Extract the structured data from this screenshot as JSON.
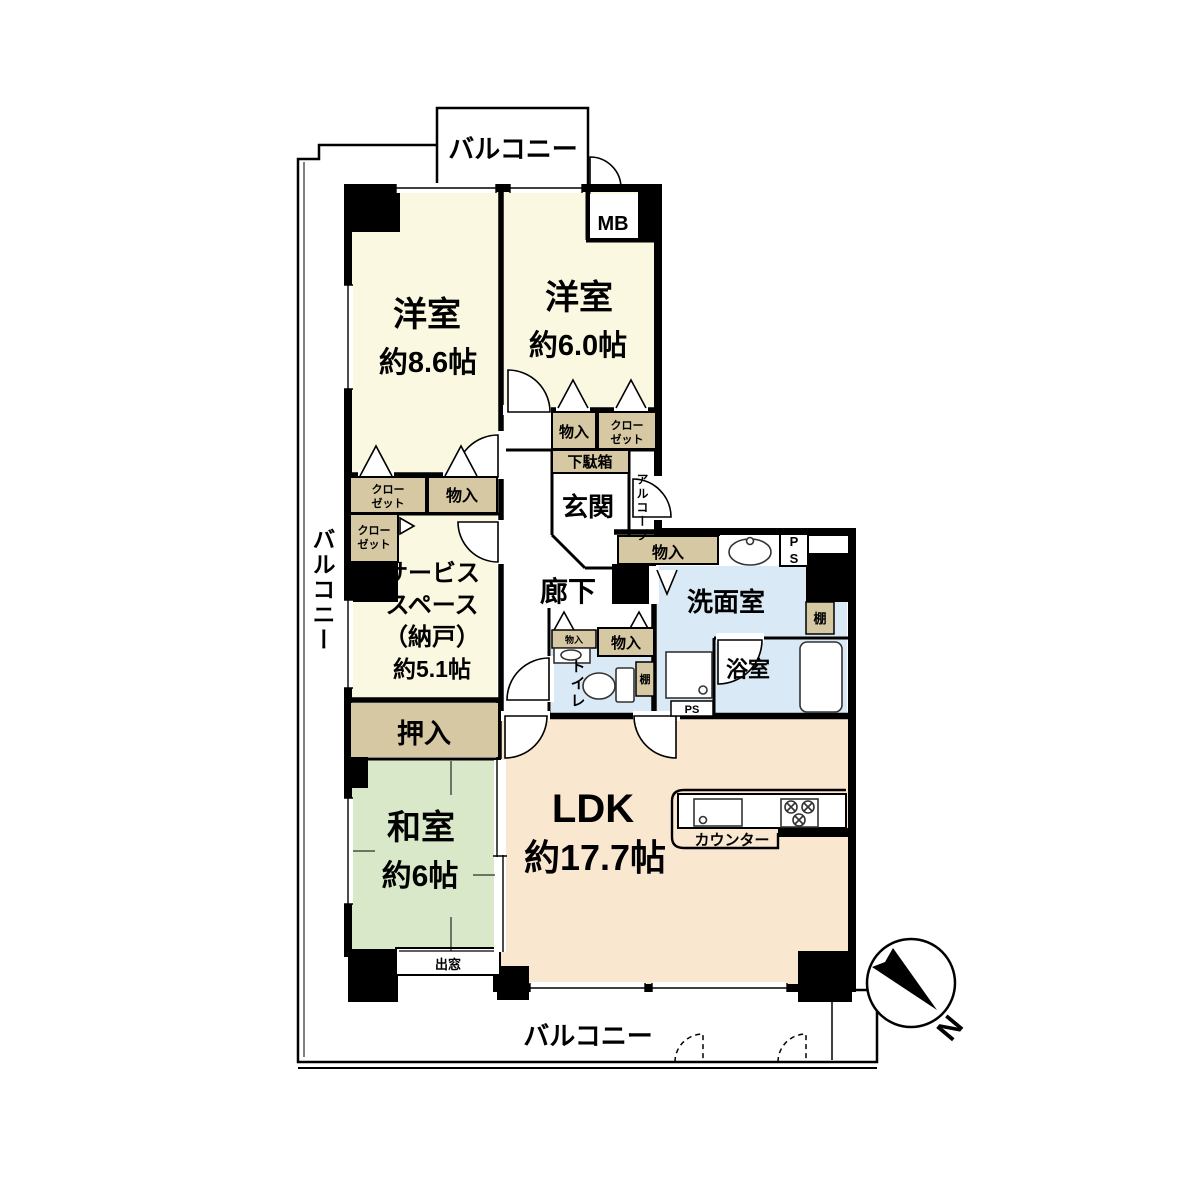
{
  "fp": {
    "balconies": {
      "top": "バルコニー",
      "left": "バルコニー",
      "bottom": "バルコニー"
    },
    "rooms": {
      "western1": {
        "name": "洋室",
        "size": "約8.6帖"
      },
      "western2": {
        "name": "洋室",
        "size": "約6.0帖"
      },
      "service": {
        "l1": "サービス",
        "l2": "スペース",
        "l3": "（納戸）",
        "l4": "約5.1帖"
      },
      "japanese": {
        "name": "和室",
        "size": "約6帖"
      },
      "ldk": {
        "name": "LDK",
        "size": "約17.7帖"
      },
      "genkan": "玄関",
      "hallway": "廊下",
      "washroom": "洗面室",
      "bathroom": "浴室",
      "toilet": "トイレ",
      "alcove": "アルコープ"
    },
    "storage": {
      "mb": "MB",
      "monoire": "物入",
      "closet1": "クロー",
      "closet2": "ゼット",
      "getabako": "下駄箱",
      "oshiire": "押入",
      "shelf": "棚",
      "ps": "PS",
      "baywindow": "出窓",
      "counter": "カウンター"
    },
    "compass": {
      "north": "N"
    },
    "colors": {
      "cream": "#FBF8E1",
      "green": "#D9E8C8",
      "peach": "#FAE7CF",
      "blue": "#D9EAF6",
      "beige": "#D5C8A3"
    }
  }
}
